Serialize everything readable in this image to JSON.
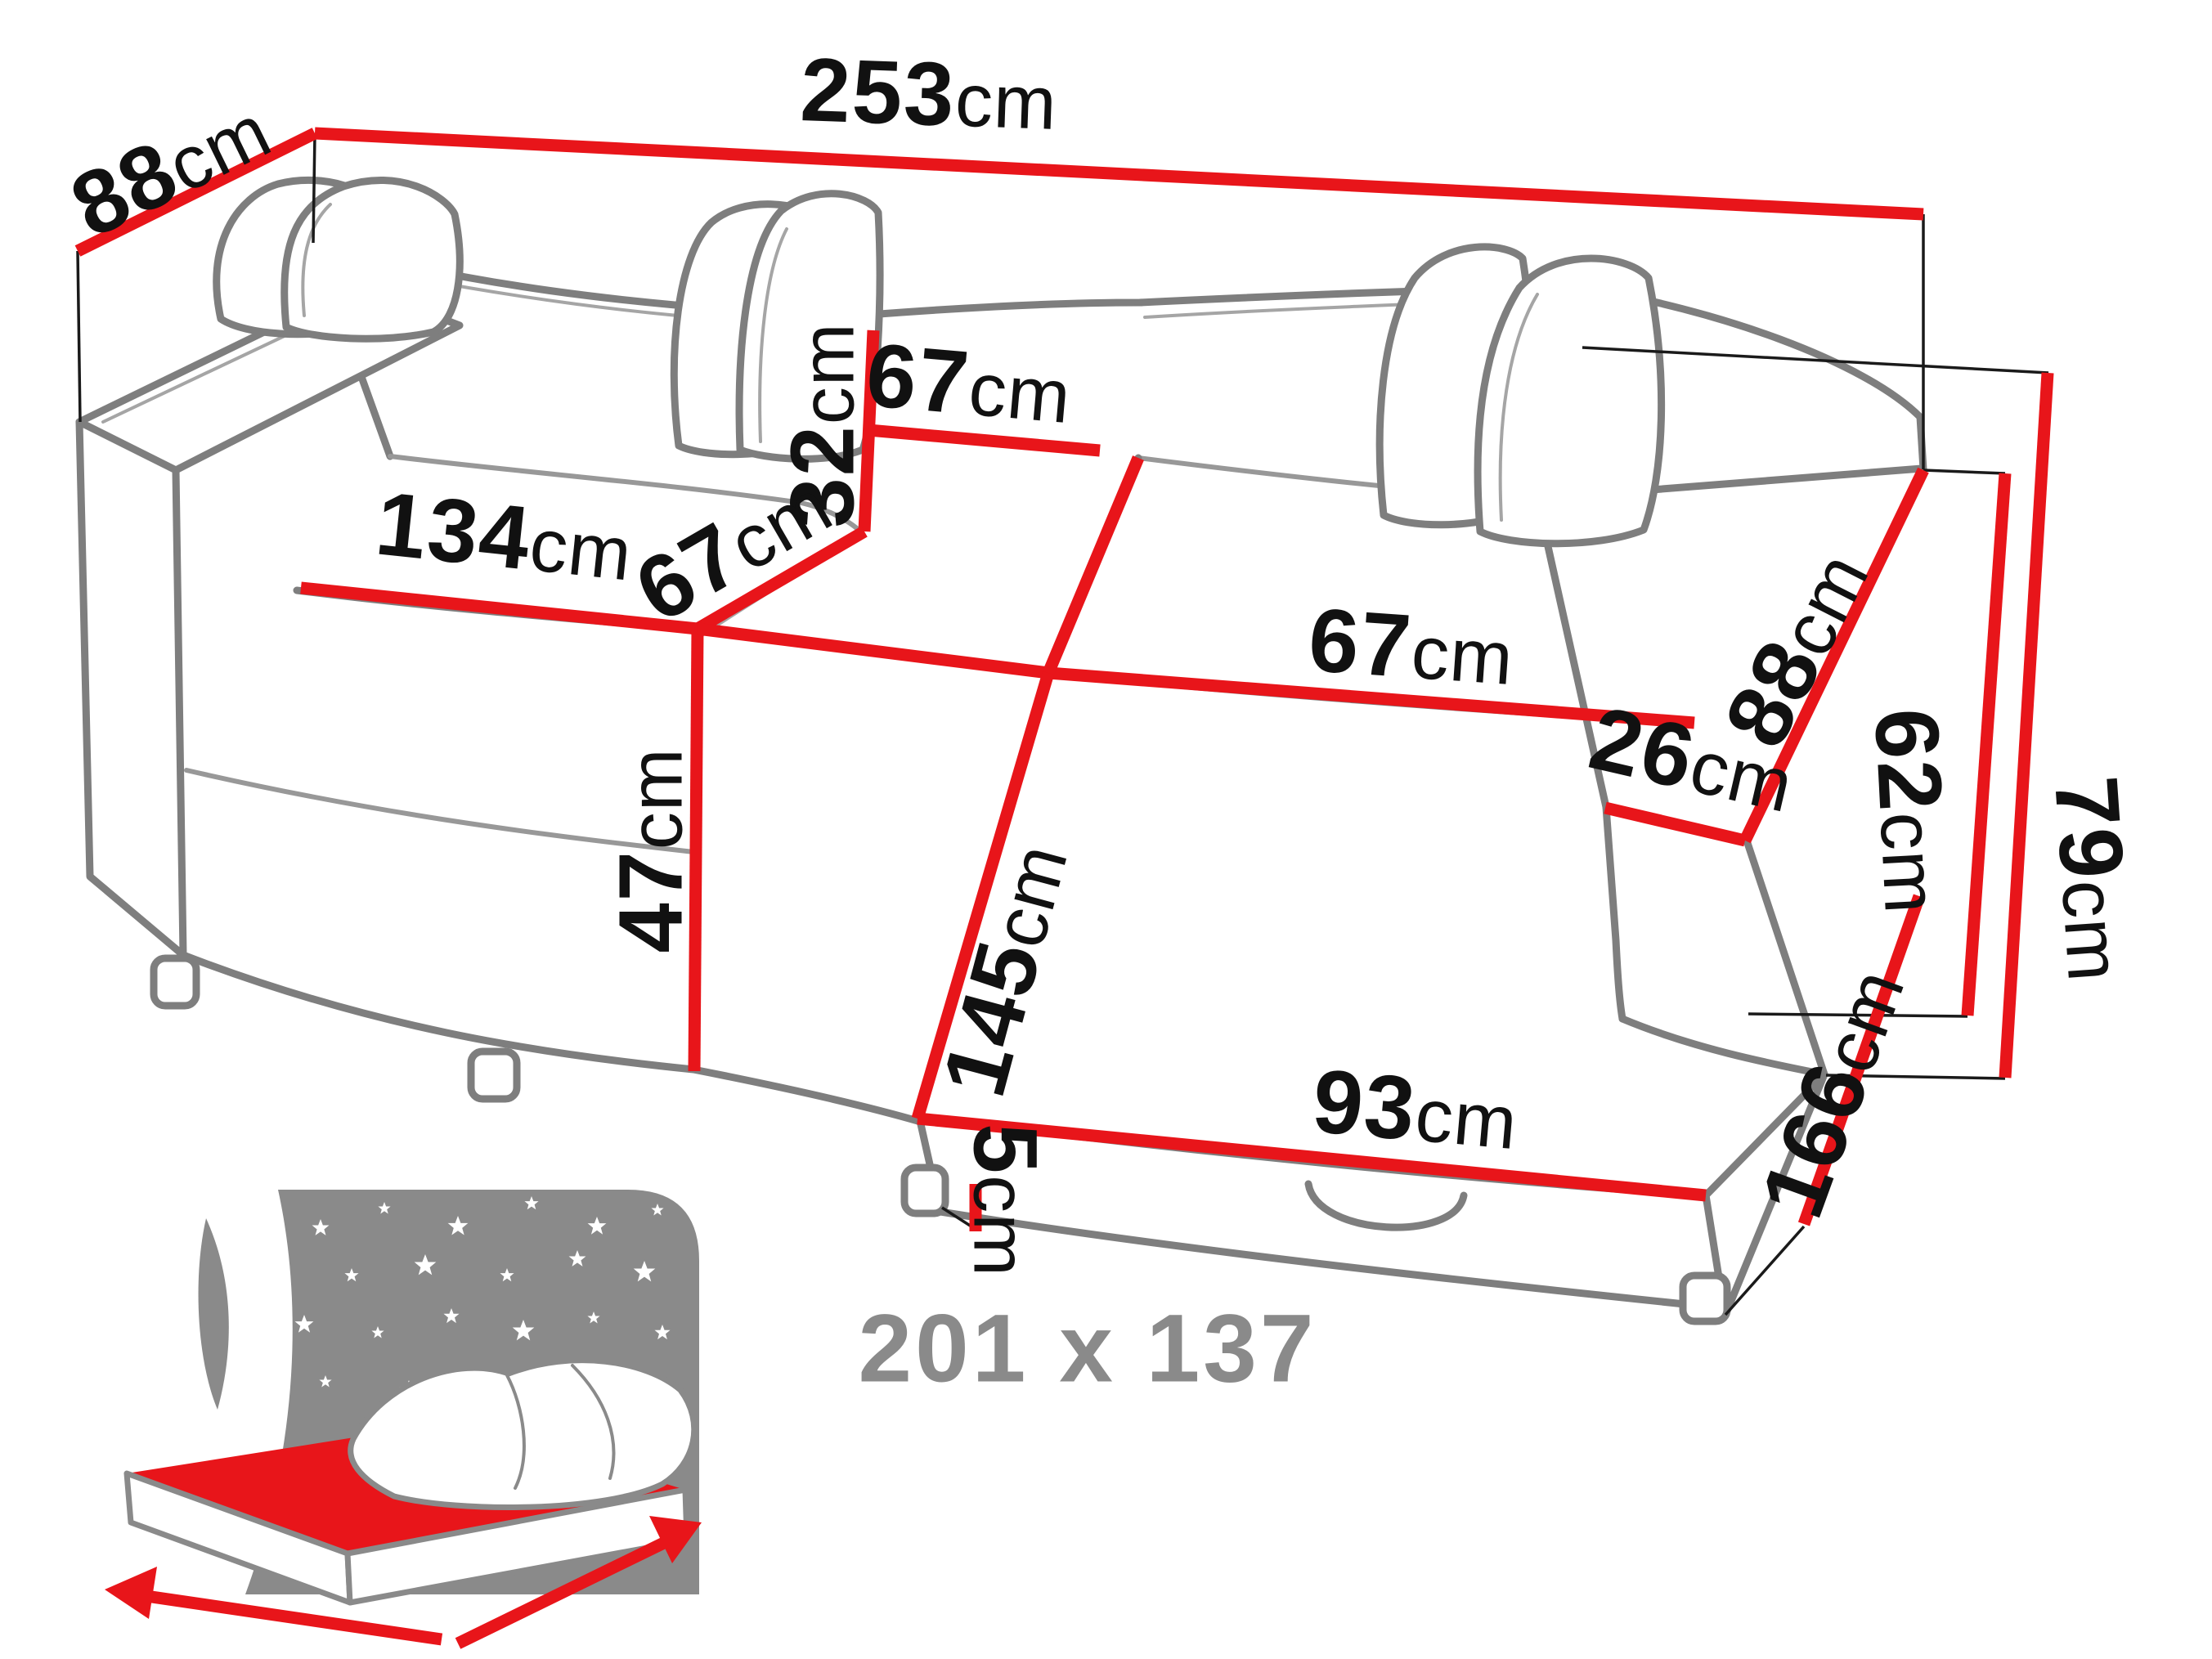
{
  "colors": {
    "dimension_red": "#e8151a",
    "sketch_gray": "#7e7e7e",
    "label_black": "#111111",
    "icon_gray": "#8a8a8a"
  },
  "dims": {
    "depth": {
      "num": "88",
      "unit": "cm"
    },
    "width_total": {
      "num": "253",
      "unit": "cm"
    },
    "backrest_height": {
      "num": "32",
      "unit": "cm"
    },
    "backrest_width": {
      "num": "67",
      "unit": "cm"
    },
    "seat_depth_left": {
      "num": "67",
      "unit": "cm"
    },
    "seat_width": {
      "num": "134",
      "unit": "cm"
    },
    "seat_height": {
      "num": "47",
      "unit": "cm"
    },
    "seat_depth_right": {
      "num": "67",
      "unit": "cm"
    },
    "sleep_length": {
      "num": "145",
      "unit": "cm"
    },
    "chaise_width": {
      "num": "93",
      "unit": "cm"
    },
    "armrest_width": {
      "num": "26",
      "unit": "cm"
    },
    "armrest_depth": {
      "num": "88",
      "unit": "cm"
    },
    "armrest_height": {
      "num": "62",
      "unit": "cm"
    },
    "total_height": {
      "num": "79",
      "unit": "cm"
    },
    "chaise_depth": {
      "num": "166",
      "unit": "cm"
    },
    "leg_height": {
      "num": "5",
      "unit": "cm"
    },
    "bed_size": {
      "num": "201 x 137",
      "unit": ""
    }
  }
}
